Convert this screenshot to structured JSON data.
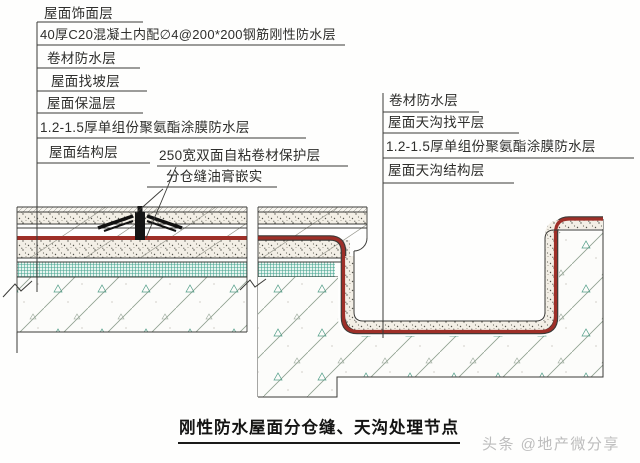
{
  "colors": {
    "membrane_red": "#9e2f28",
    "insulation_green": "#3fa18d",
    "ink": "#2e2e2c",
    "watermark_gray": "#bdbdbd"
  },
  "left_labels": [
    "屋面饰面层",
    "40厚C20混凝土内配∅4@200*200钢筋刚性防水层",
    "卷材防水层",
    "屋面找坡层",
    "屋面保温层",
    "1.2-1.5厚单组份聚氨酯涂膜防水层",
    "屋面结构层"
  ],
  "callouts": [
    "250宽双面自粘卷材保护层",
    "分仓缝油膏嵌实"
  ],
  "right_labels": [
    "卷材防水层",
    "屋面天沟找平层",
    "1.2-1.5厚单组份聚氨酯涂膜防水层",
    "屋面天沟结构层"
  ],
  "title": "刚性防水屋面分仓缝、天沟处理节点",
  "watermark": "头条 @地产微分享"
}
